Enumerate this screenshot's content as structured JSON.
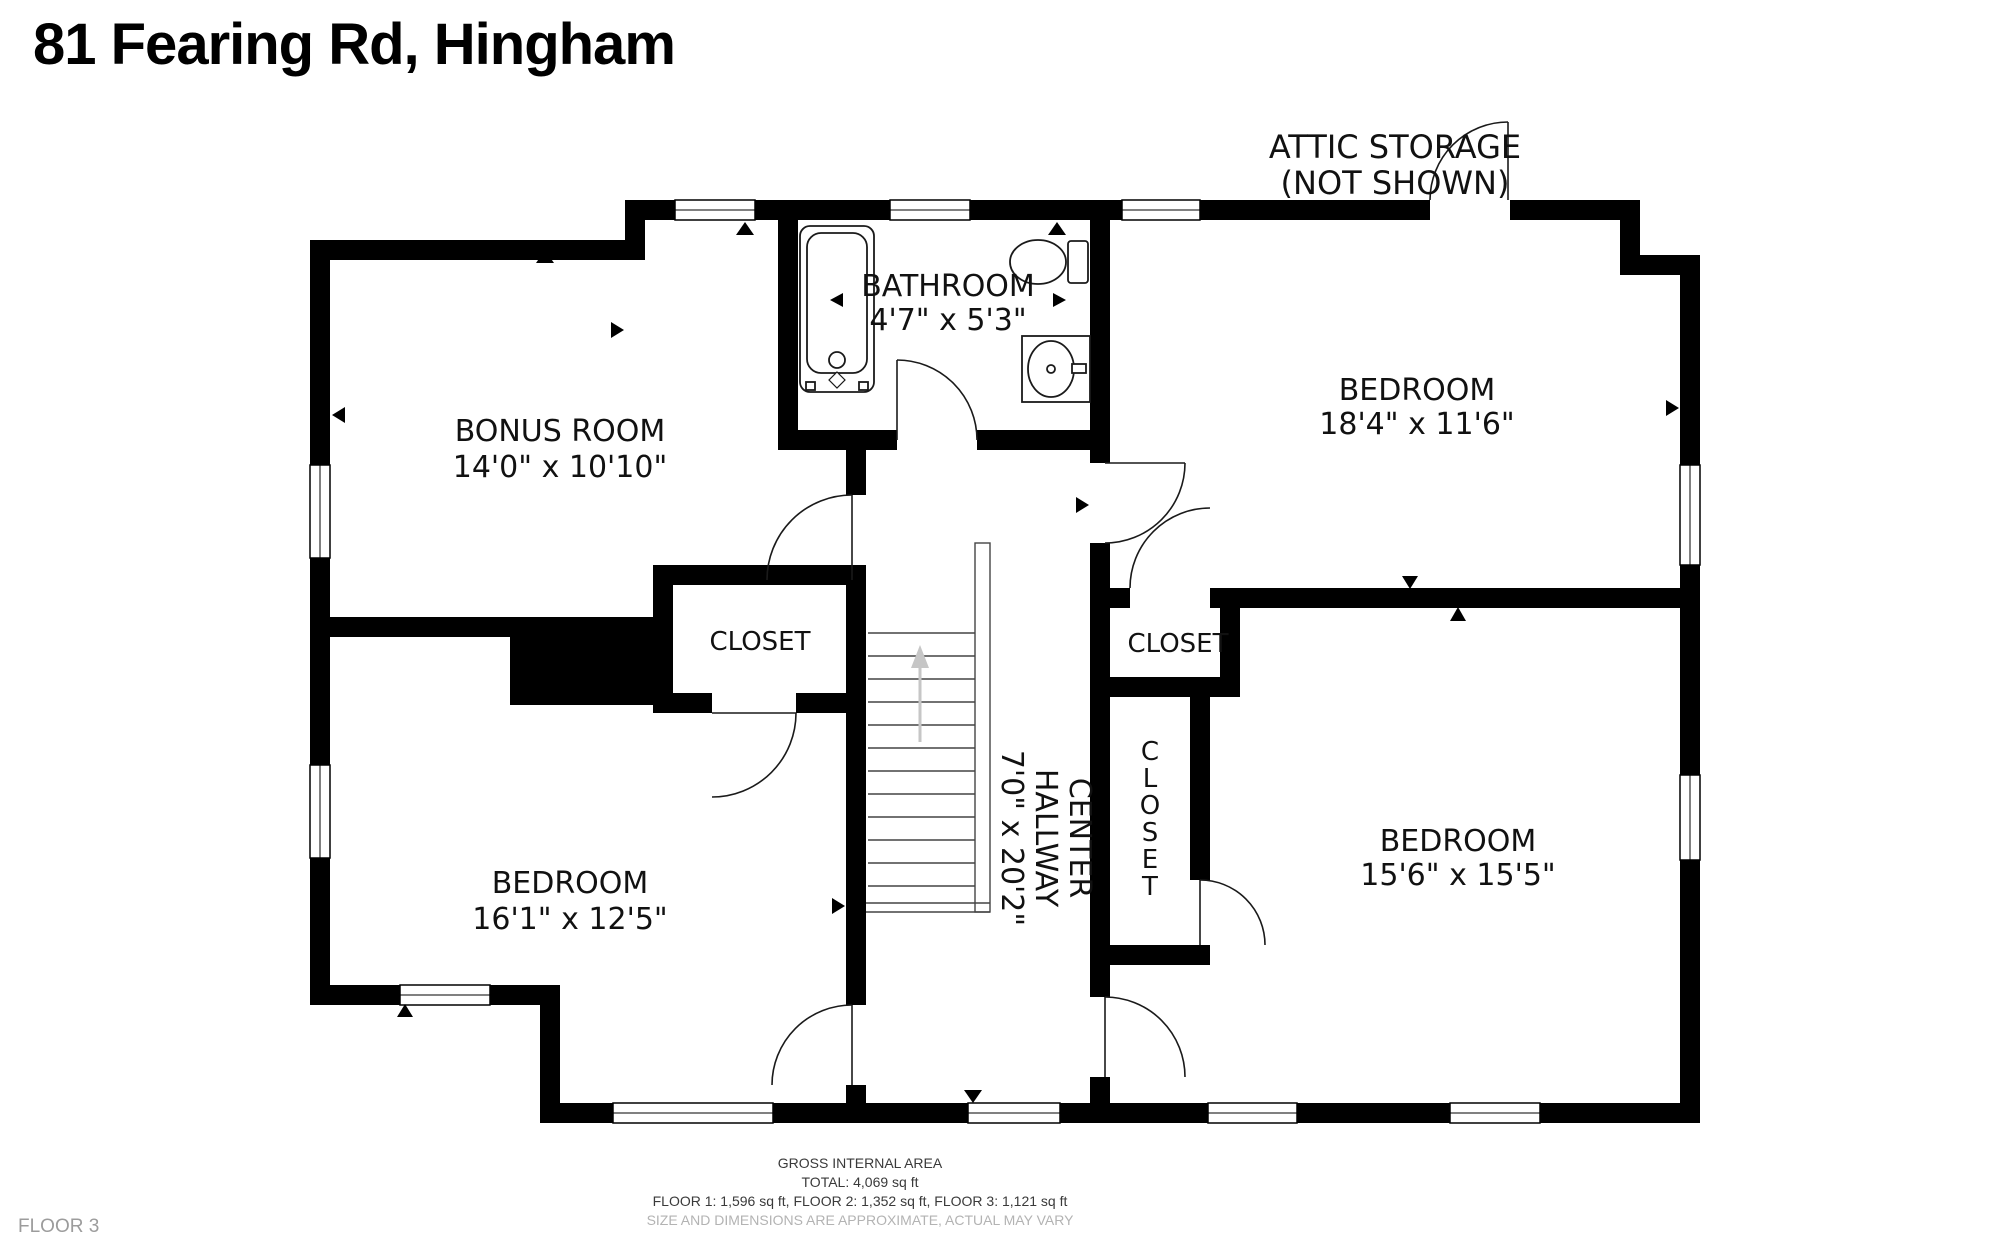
{
  "title": "81 Fearing Rd, Hingham",
  "floor_label": "FLOOR 3",
  "attic_note": {
    "line1": "ATTIC STORAGE",
    "line2": "(NOT SHOWN)"
  },
  "rooms": {
    "bonus": {
      "name": "BONUS ROOM",
      "dims": "14'0\" x 10'10\""
    },
    "bathroom": {
      "name": "BATHROOM",
      "dims": "4'7\" x 5'3\""
    },
    "bedroom_top_right": {
      "name": "BEDROOM",
      "dims": "18'4\" x 11'6\""
    },
    "bedroom_bottom_left": {
      "name": "BEDROOM",
      "dims": "16'1\" x 12'5\""
    },
    "bedroom_bottom_right": {
      "name": "BEDROOM",
      "dims": "15'6\" x 15'5\""
    },
    "hallway": {
      "line1": "CENTER",
      "line2": "HALLWAY",
      "dims": "7'0\" x 20'2\""
    },
    "closet_left": {
      "name": "CLOSET"
    },
    "closet_right": {
      "name": "CLOSET"
    },
    "closet_vertical": {
      "letters": [
        "C",
        "L",
        "O",
        "S",
        "E",
        "T"
      ]
    }
  },
  "footer": {
    "line1": "GROSS INTERNAL AREA",
    "line2": "TOTAL: 4,069 sq ft",
    "line3": "FLOOR 1: 1,596 sq ft, FLOOR 2: 1,352 sq ft, FLOOR 3: 1,121 sq ft",
    "line4": "SIZE AND DIMENSIONS ARE APPROXIMATE, ACTUAL MAY VARY"
  },
  "colors": {
    "wall": "#000000",
    "stair_arrow": "#c6c6c6",
    "muted": "#b3b3b3"
  }
}
